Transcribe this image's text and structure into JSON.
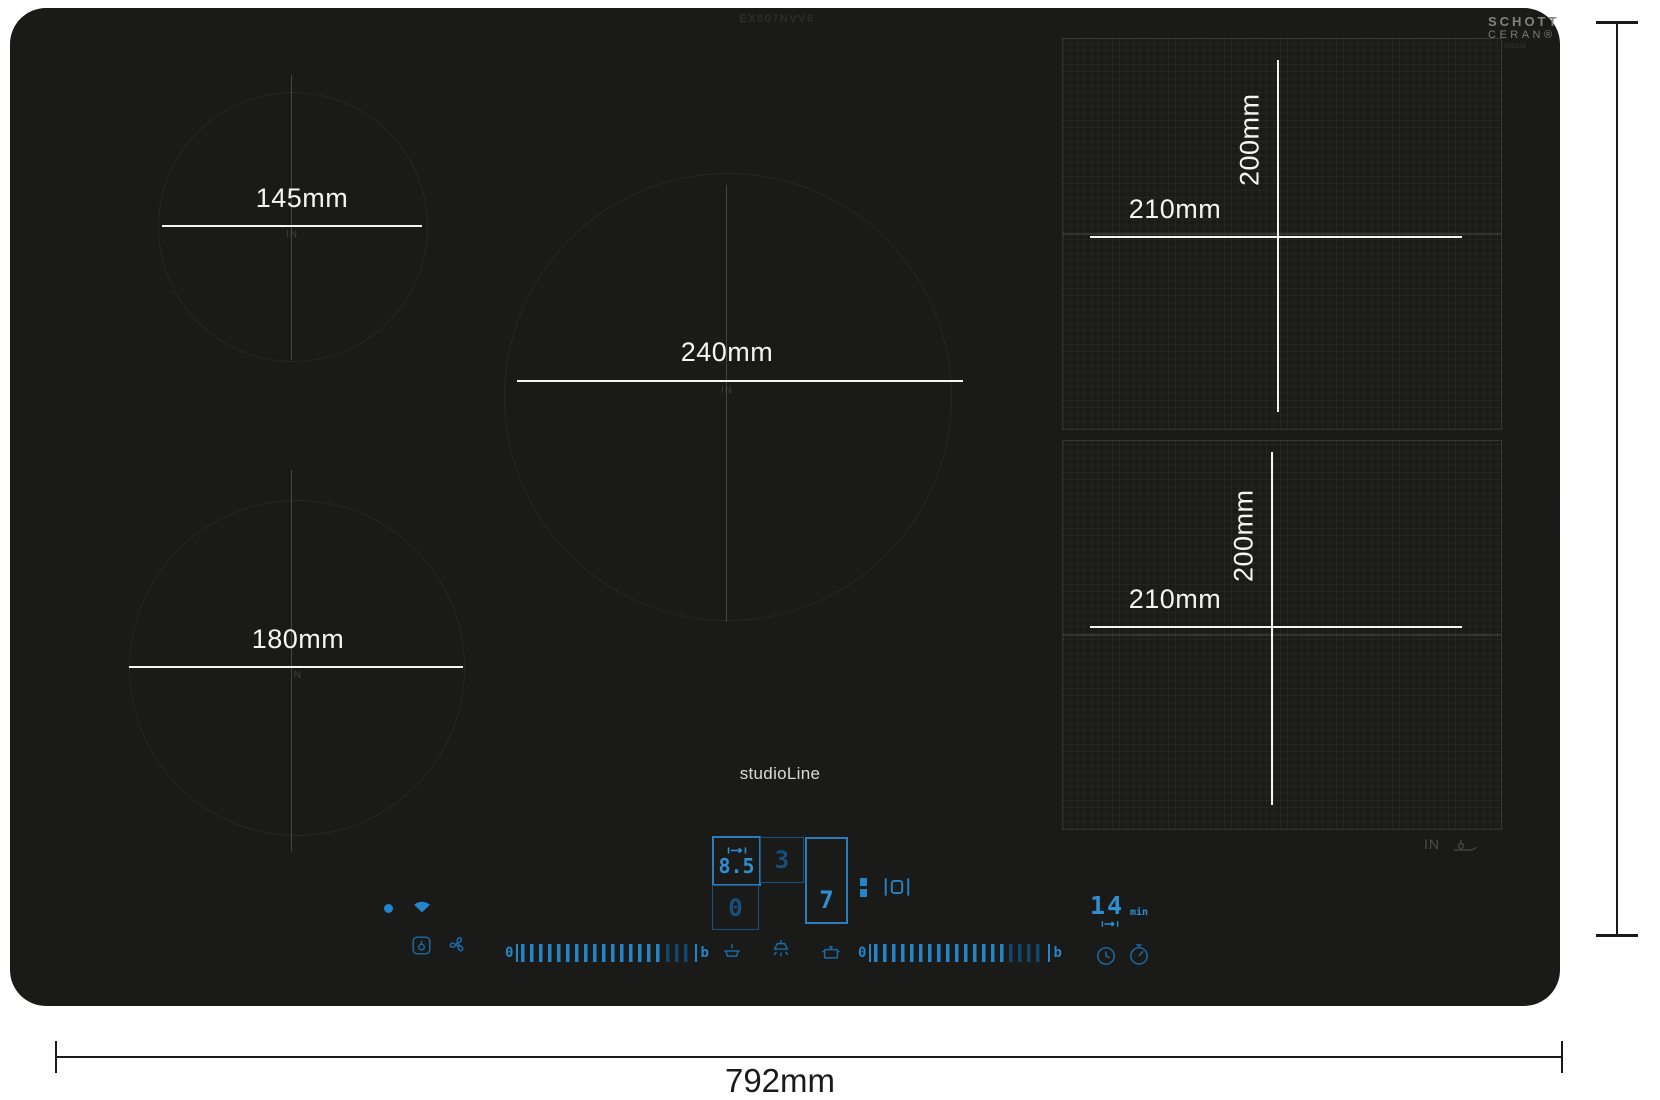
{
  "product": {
    "model_number": "EX807NVV6",
    "series_label": "studioLine",
    "glass_logo_line1": "SCHOTT",
    "glass_logo_line2": "CERAN®",
    "glass_part_number": "9001708235"
  },
  "overall_dimensions": {
    "width_label": "792mm",
    "depth_label": "512mm"
  },
  "burners": [
    {
      "diameter_label": "145mm",
      "in_label": "IN"
    },
    {
      "diameter_label": "240mm",
      "in_label": "IN"
    },
    {
      "diameter_label": "180mm",
      "in_label": "IN"
    }
  ],
  "flex_zones": [
    {
      "width_label": "210mm",
      "depth_label": "200mm"
    },
    {
      "width_label": "210mm",
      "depth_label": "200mm"
    }
  ],
  "glass_markings": {
    "in_label": "IN"
  },
  "controls": {
    "zone_displays": {
      "flex_level": "8.5",
      "hood_level": "3",
      "right_zone_level": "7",
      "bottom_zone_level": "0"
    },
    "timer": {
      "value": "14",
      "unit": "min"
    },
    "power_slider": {
      "min_label": "0",
      "boost_label": "b"
    },
    "icons": [
      "power-indicator-dot",
      "wifi",
      "flex-zone-bridge",
      "pause",
      "pan-move",
      "wipe-protection",
      "hood-fan",
      "pan-transfer",
      "hood-light",
      "pot",
      "clock",
      "kitchen-timer",
      "pan-sensor"
    ]
  },
  "colors": {
    "accent_blue": "#2485c9",
    "accent_blue_dim": "#174f7c",
    "cooktop_black": "#1a1a19",
    "dimension_line_black": "#1a1a1a",
    "measure_line_white": "#f5f5f5"
  }
}
